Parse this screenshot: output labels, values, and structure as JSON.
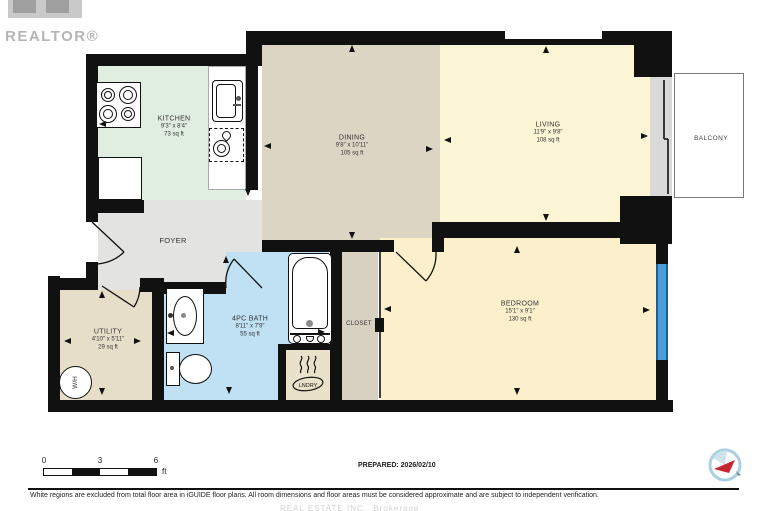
{
  "branding": {
    "realtor_logo_text": "REALTOR®",
    "iguide_logo": "iguide-compass-logo"
  },
  "rooms": [
    {
      "id": "kitchen",
      "name": "KITCHEN",
      "dims": "9'3\" x 8'4\"",
      "area": "73 sq ft"
    },
    {
      "id": "dining",
      "name": "DINING",
      "dims": "9'8\" x 10'11\"",
      "area": "105 sq ft"
    },
    {
      "id": "living",
      "name": "LIVING",
      "dims": "11'9\" x 9'8\"",
      "area": "108 sq ft"
    },
    {
      "id": "bedroom",
      "name": "BEDROOM",
      "dims": "15'1\" x 9'1\"",
      "area": "130 sq ft"
    },
    {
      "id": "bath",
      "name": "4PC BATH",
      "dims": "8'11\" x 7'9\"",
      "area": "55 sq ft"
    },
    {
      "id": "utility",
      "name": "UTILITY",
      "dims": "4'10\" x 5'11\"",
      "area": "29 sq ft"
    },
    {
      "id": "foyer",
      "name": "FOYER"
    },
    {
      "id": "closet",
      "name": "CLOSET"
    },
    {
      "id": "balcony",
      "name": "BALCONY"
    },
    {
      "id": "laundry",
      "name": "LNDRY"
    }
  ],
  "fixtures": {
    "water_heater": "W/H"
  },
  "scale_bar": {
    "ticks": [
      "0",
      "3",
      "6"
    ],
    "unit": "ft"
  },
  "footer": {
    "prepared": "PREPARED: 2026/02/10",
    "disclaimer": "White regions are excluded from total floor area in iGUIDE floor plans. All room dimensions and floor areas must be considered approximate and are subject to independent verification.",
    "watermark": "REAL ESTATE INC., Brokerage"
  },
  "colors": {
    "wall": "#111111",
    "kitchen": "#e0eee2",
    "dining": "#ddd5c4",
    "living": "#fbf4d5",
    "bedroom": "#fbefcc",
    "foyer": "#e3e3e1",
    "utility": "#e7dec9",
    "bath": "#c0e0f4",
    "closet": "#d8d1c1",
    "laundry": "#eae1cb",
    "window_blue": "#4aa0d8",
    "compass_red": "#c4272e"
  }
}
